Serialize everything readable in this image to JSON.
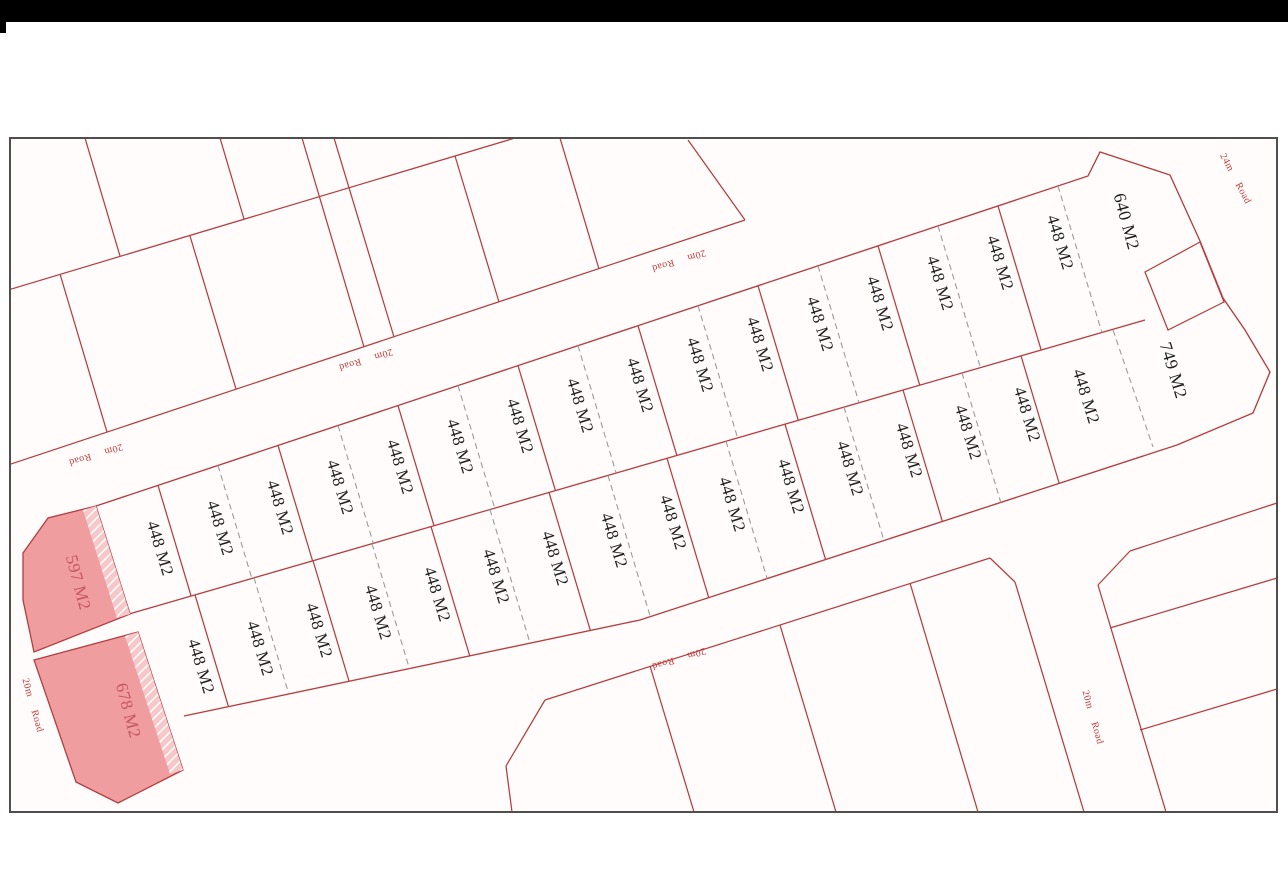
{
  "window": {
    "top_bar_color": "#000000",
    "background_color": "#ffffff"
  },
  "plan": {
    "description": "Land subdivision plot plan",
    "standard_plot_area": "448 M2",
    "row1_plots": [
      "448 M2",
      "448 M2",
      "448 M2",
      "448 M2",
      "448 M2",
      "448 M2",
      "448 M2",
      "448 M2",
      "448 M2",
      "448 M2",
      "448 M2",
      "448 M2",
      "448 M2",
      "448 M2",
      "448 M2",
      "448 M2"
    ],
    "row2_plots": [
      "448 M2",
      "448 M2",
      "448 M2",
      "448 M2",
      "448 M2",
      "448 M2",
      "448 M2",
      "448 M2",
      "448 M2",
      "448 M2",
      "448 M2",
      "448 M2",
      "448 M2",
      "448 M2",
      "448 M2",
      "448 M2"
    ],
    "end_plots": {
      "left_top": "597 M2",
      "left_bottom": "678 M2",
      "right_top": "640 M2",
      "right_bottom": "749 M2"
    },
    "road_labels": [
      "20m Road",
      "20m Road",
      "20m Road",
      "20m Road",
      "20m Road",
      "20m Road",
      "24m Road"
    ],
    "colors": {
      "plot_line": "#b43e40",
      "dashed_line": "#9b9b9b",
      "highlight_fill": "#f09da0",
      "road_text": "#c23b3b",
      "plot_text": "#1f1f1f",
      "frame": "#4f4f4f",
      "map_background": "#fffcfb"
    }
  }
}
